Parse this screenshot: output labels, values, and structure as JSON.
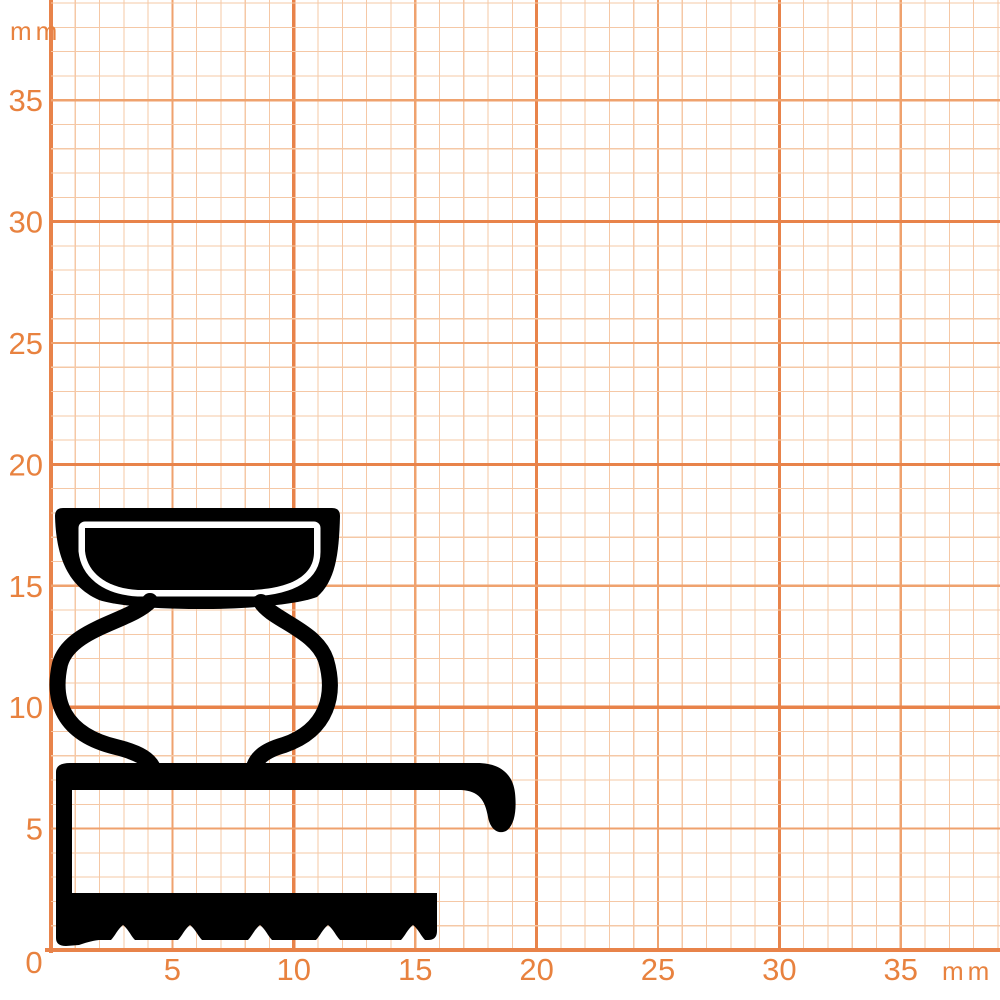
{
  "meta": {
    "description": "Cross-section profile of a rubber sealing gasket drawn on orange millimeter graph paper",
    "type": "technical-profile-drawing"
  },
  "colors": {
    "background": "#FFFFFF",
    "grid_minor": "#F5C8A6",
    "grid_mid": "#EFA26E",
    "grid_major": "#E8834A",
    "axis": "#E8834A",
    "label": "#E8823F",
    "profile": "#000000"
  },
  "grid": {
    "unit": "mm",
    "origin_x": 51,
    "origin_y": 950,
    "px_per_mm": 24.28,
    "mm_lines_x": 39,
    "mm_lines_y": 39,
    "tick_step_mm": 5
  },
  "axes": {
    "x_ticks": [
      "5",
      "10",
      "15",
      "20",
      "25",
      "30",
      "35"
    ],
    "y_ticks": [
      "5",
      "10",
      "15",
      "20",
      "25",
      "30",
      "35"
    ],
    "origin_label": "0",
    "unit_label_top": "mm",
    "unit_label_bottom": "mm"
  },
  "profile": {
    "fill": "#000000",
    "extent_mm": {
      "width": 19.2,
      "height": 18.3
    },
    "stroke_widths": {
      "bulb_walls": 16,
      "inner_bowl_halo": 13
    },
    "paths": {
      "bowl_outer": "M 55 516 Q 55 508 63 508 L 332 508 Q 340 508 340 516 C 339 556 335 581 317 597 C 276 612 140 613 99 600 C 65 585 56 552 55 516 Z",
      "inner_bowl": "M 85 528 L 314 528 L 314 552 C 314 574 294 588 252 590 L 138 590 C 104 588 87 571 85 551 Z",
      "left_strand": "M 150 601 C 130 622 70 628 60 664 C 52 700 62 734 116 747 C 140 753 151 760 154 771",
      "right_strand": "M 261 602 C 272 620 316 630 326 660 C 336 694 328 730 284 745 C 263 751 255 759 253 771",
      "base": "M 56 772 Q 56 763 70 763 L 477 763 C 500 763 513 774 515 793 C 517 812 514 826 506 831 C 497 835 490 828 488 817 C 485 800 479 791 461 790 L 72 790 L 72 893 L 437 893 L 437 931 Q 437 940 428 940 L 425 940 C 421 936 419 930 413 925 C 407 930 405 936 401 940 L 340 940 C 336 936 334 930 328 925 C 322 930 320 936 316 940 L 272 940 C 268 936 266 930 260 925 C 254 930 252 936 248 940 L 202 940 C 198 936 196 930 190 925 C 184 930 182 936 178 940 L 135 940 C 131 936 129 930 123 925 C 117 930 115 936 111 940 L 99 940 C 91 941 85 943 79 945 L 66 946 Q 56 946 56 938 Z"
    }
  }
}
